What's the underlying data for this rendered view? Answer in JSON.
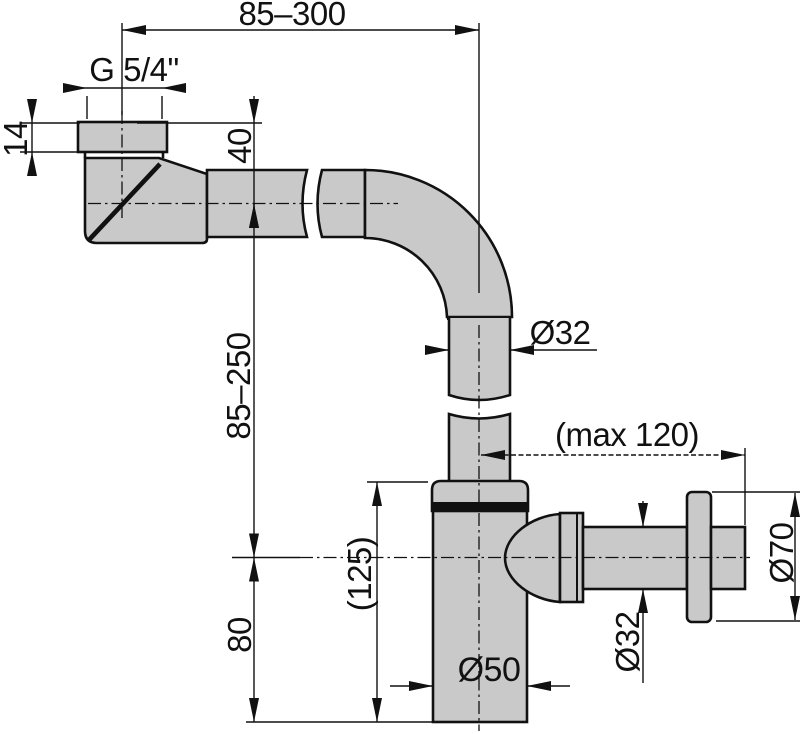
{
  "drawing": {
    "type": "technical-dimension-drawing",
    "subject": "bottle trap (siphon) with wall outlet, side view with dimensions",
    "units": "mm",
    "colors": {
      "background": "#ffffff",
      "pipe_fill": "#c9c9c9",
      "line": "#111111"
    },
    "labels": {
      "top_span": "85–300",
      "thread_size": "G 5/4\"",
      "nut_height": "14",
      "inlet_drop": "40",
      "riser_span": "85–250",
      "lower_height": "80",
      "trap_height": "(125)",
      "riser_diameter": "Ø32",
      "wall_distance": "(max 120)",
      "body_diameter": "Ø50",
      "outlet_diameter": "Ø32",
      "flange_diameter": "Ø70"
    }
  }
}
